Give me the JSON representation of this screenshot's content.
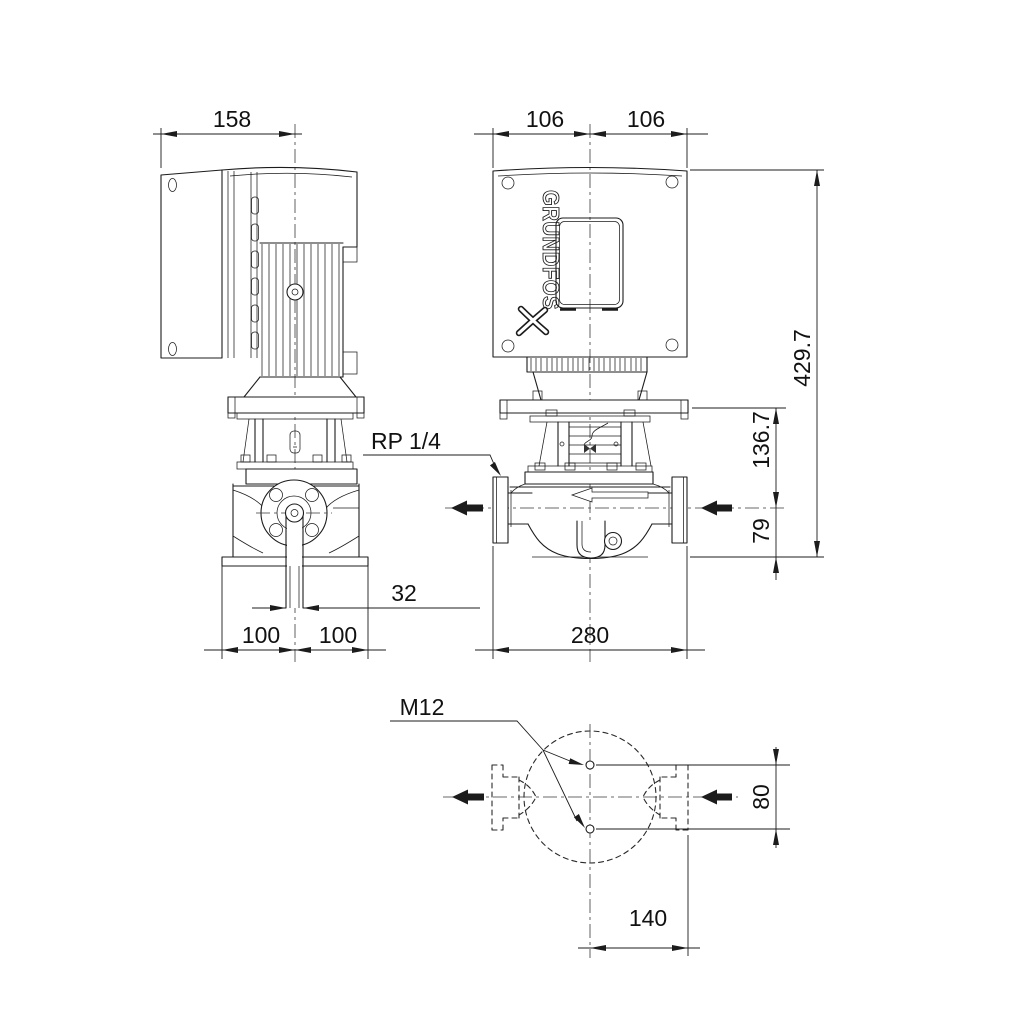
{
  "drawing": {
    "type": "pump-dimensional-drawing",
    "brand": "GRUNDFOS",
    "line_color": "#1c1c1c",
    "background": "#ffffff",
    "views": {
      "side_view": {
        "dims": {
          "motor_box_width": "158",
          "port_bore": "32",
          "half_width_left": "100",
          "half_width_right": "100"
        },
        "gauge_tapping_label": "RP 1/4"
      },
      "front_view": {
        "dims": {
          "box_half_left": "106",
          "box_half_right": "106",
          "overall_height": "429.7",
          "flange_top_to_center": "136.7",
          "center_to_base": "79",
          "port_to_port": "280"
        }
      },
      "top_view": {
        "dims": {
          "hole_spacing": "80",
          "center_to_flange_face": "140"
        },
        "thread_label": "M12"
      }
    },
    "dimensions": {
      "d158": "158",
      "d106l": "106",
      "d106r": "106",
      "d4297": "429.7",
      "d1367": "136.7",
      "d79": "79",
      "d32": "32",
      "d100l": "100",
      "d100r": "100",
      "d280": "280",
      "d80": "80",
      "d140": "140",
      "rp14": "RP 1/4",
      "m12": "M12"
    }
  }
}
